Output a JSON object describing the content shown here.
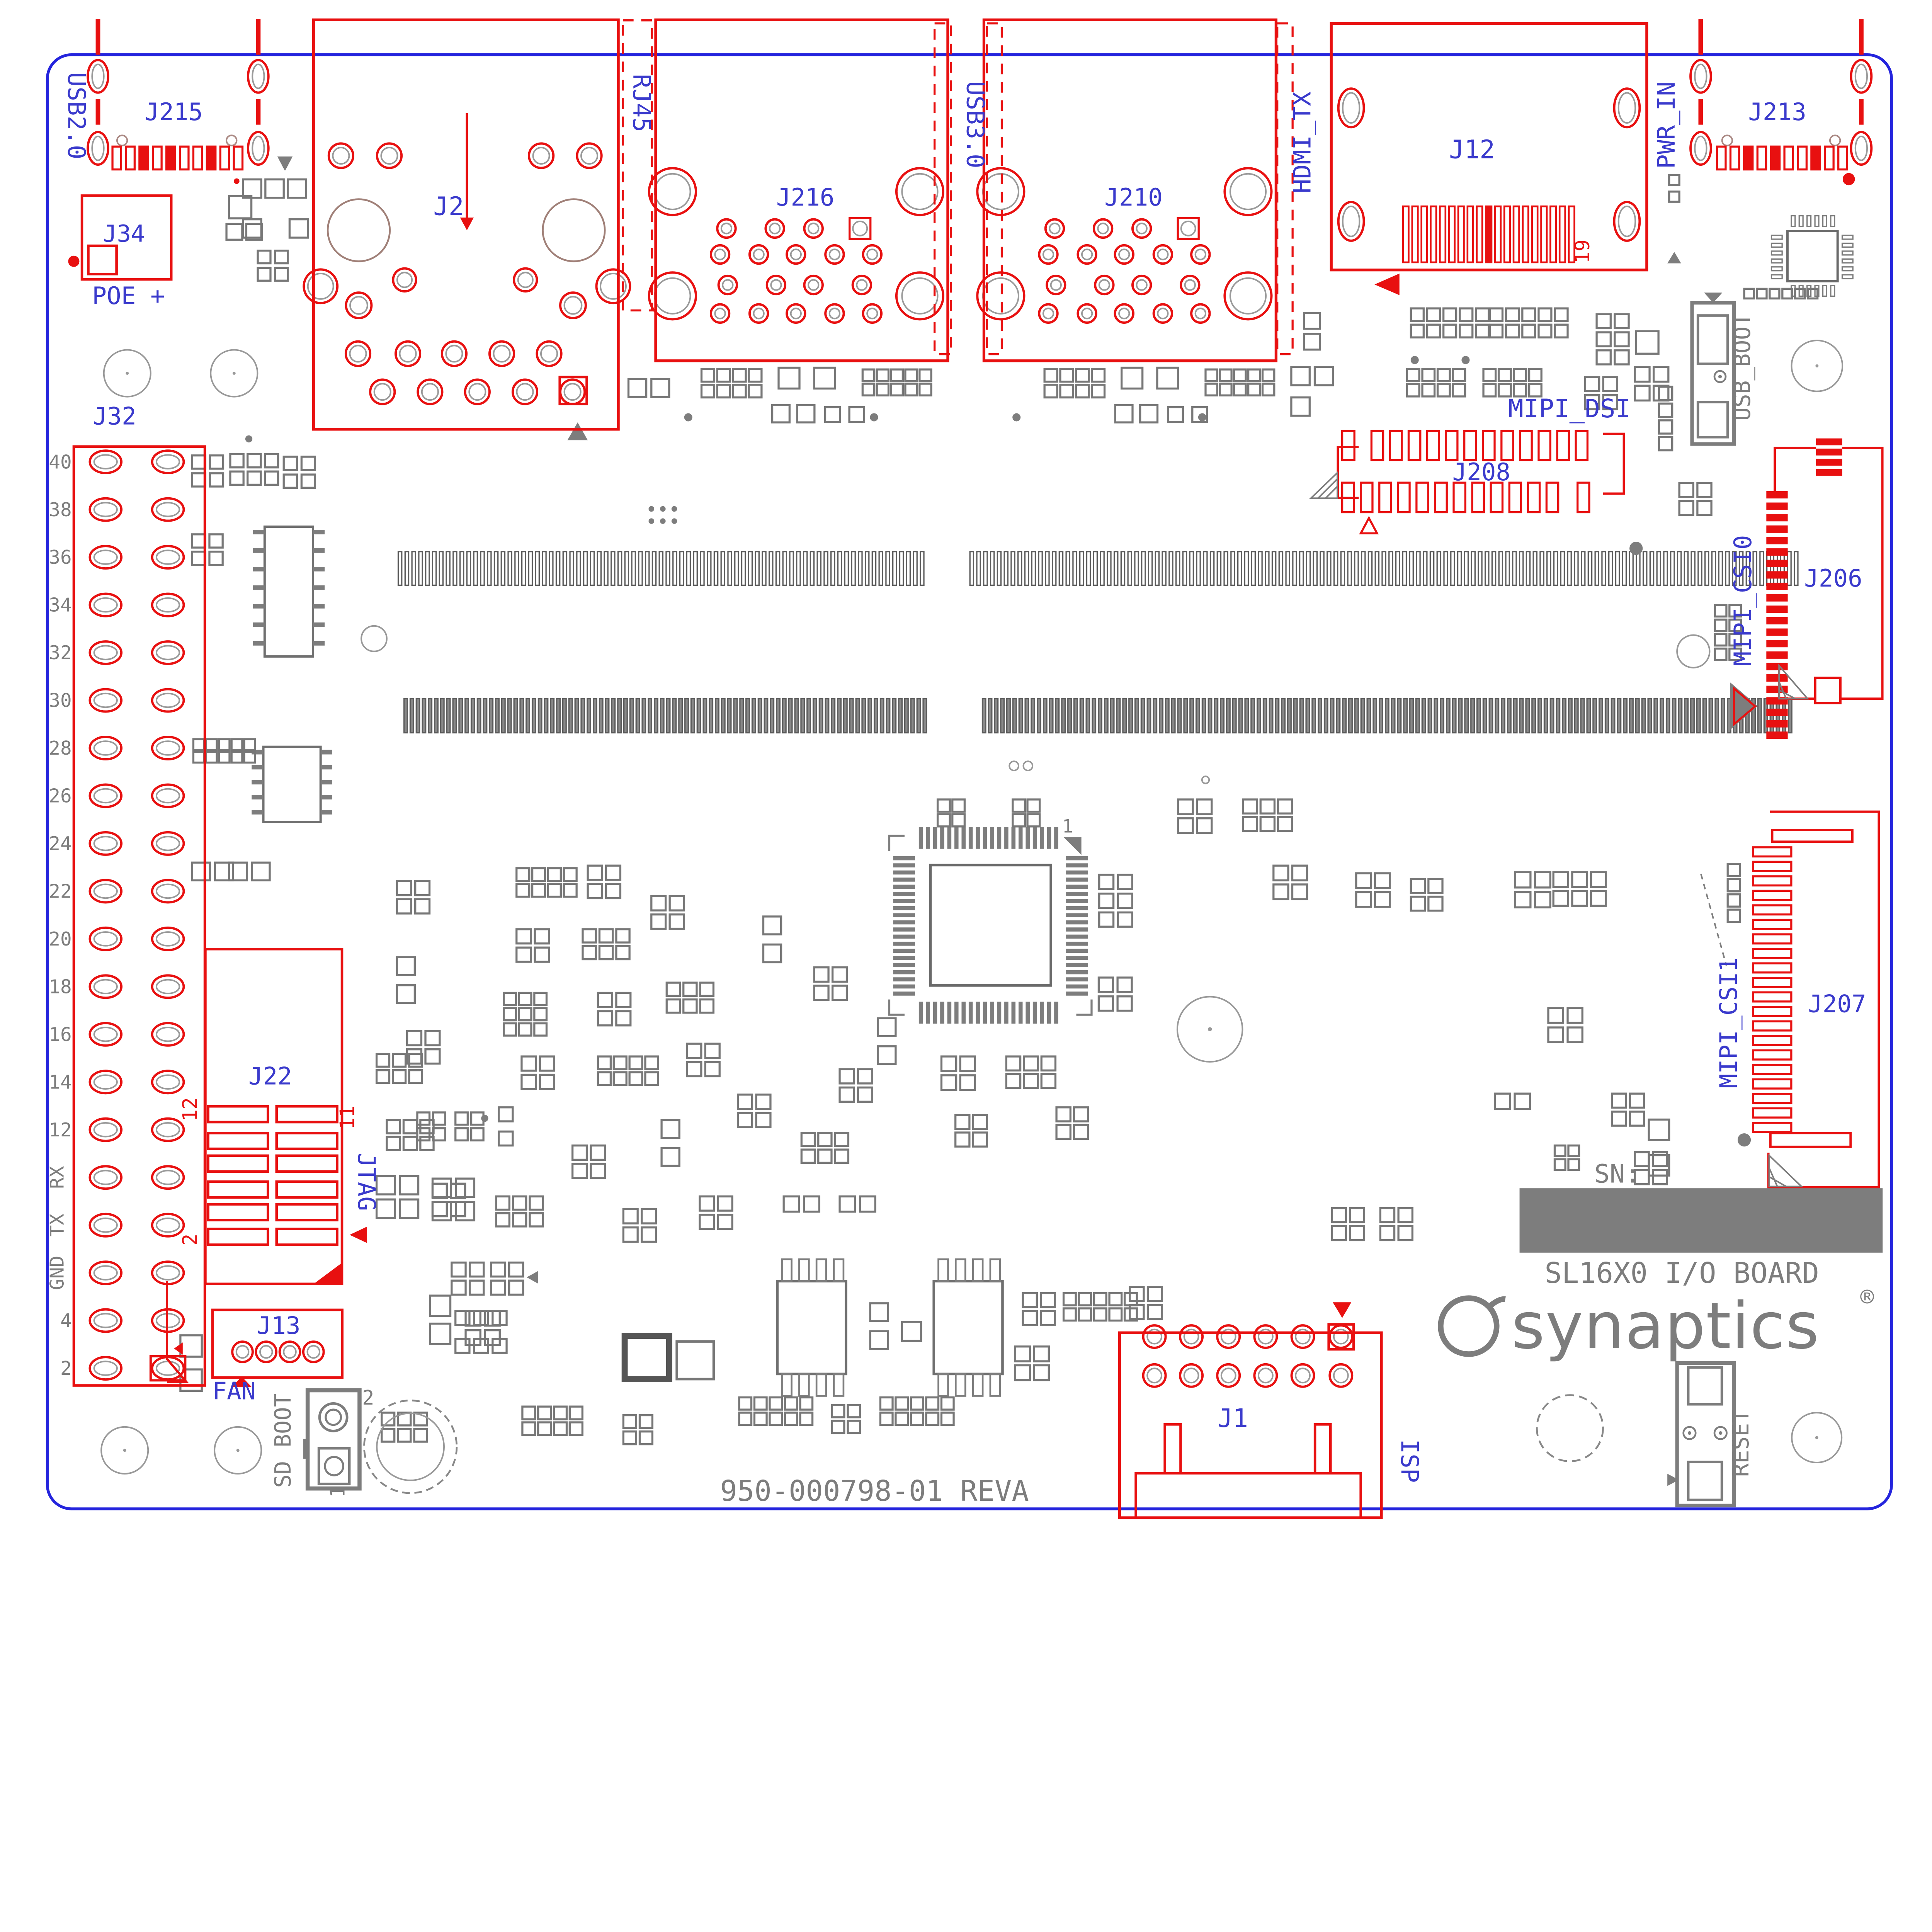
{
  "board": {
    "title": "SL16X0 I/O BOARD",
    "part_number": "950-000798-01 REVA",
    "brand": "synaptics",
    "brand_reg": "®",
    "serial_label": "SN:"
  },
  "colors": {
    "red": "#e81010",
    "blue": "#2424dd",
    "text_blue": "#3a3acc",
    "gray": "#7d7d7d",
    "dark_gray": "#5c5c5c"
  },
  "labels": {
    "usb2": "USB2.0",
    "j215": "J215",
    "j34": "J34",
    "poe": "POE +",
    "j2": "J2",
    "rj45": "RJ45",
    "j216": "J216",
    "usb3": "USB3.0",
    "j210": "J210",
    "hdmi": "HDMI_TX",
    "j12": "J12",
    "pin19": "19",
    "pwr": "PWR_IN",
    "j213": "J213",
    "mipi_dsi": "MIPI_DSI",
    "j208": "J208",
    "usb_boot": "USB_BOOT",
    "mipi_csi0": "MIPI_CSI0",
    "j206": "J206",
    "j32": "J32",
    "j22": "J22",
    "jtag": "JTAG",
    "pin12": "12",
    "pin2": "2",
    "pin11": "11",
    "j13": "J13",
    "fan": "FAN",
    "sd_boot": "SD BOOT",
    "sw_pin2": "2",
    "sw_pin1": "1",
    "j1": "J1",
    "isp": "ISP",
    "mipi_csi1": "MIPI_CSI1",
    "j207": "J207",
    "reset": "RESET",
    "qfp_pin1": "1"
  },
  "j32_pins": [
    "40",
    "38",
    "36",
    "34",
    "32",
    "30",
    "28",
    "26",
    "24",
    "22",
    "20",
    "18",
    "16",
    "14",
    "12",
    "RX",
    "TX",
    "GND",
    "4",
    "2"
  ]
}
